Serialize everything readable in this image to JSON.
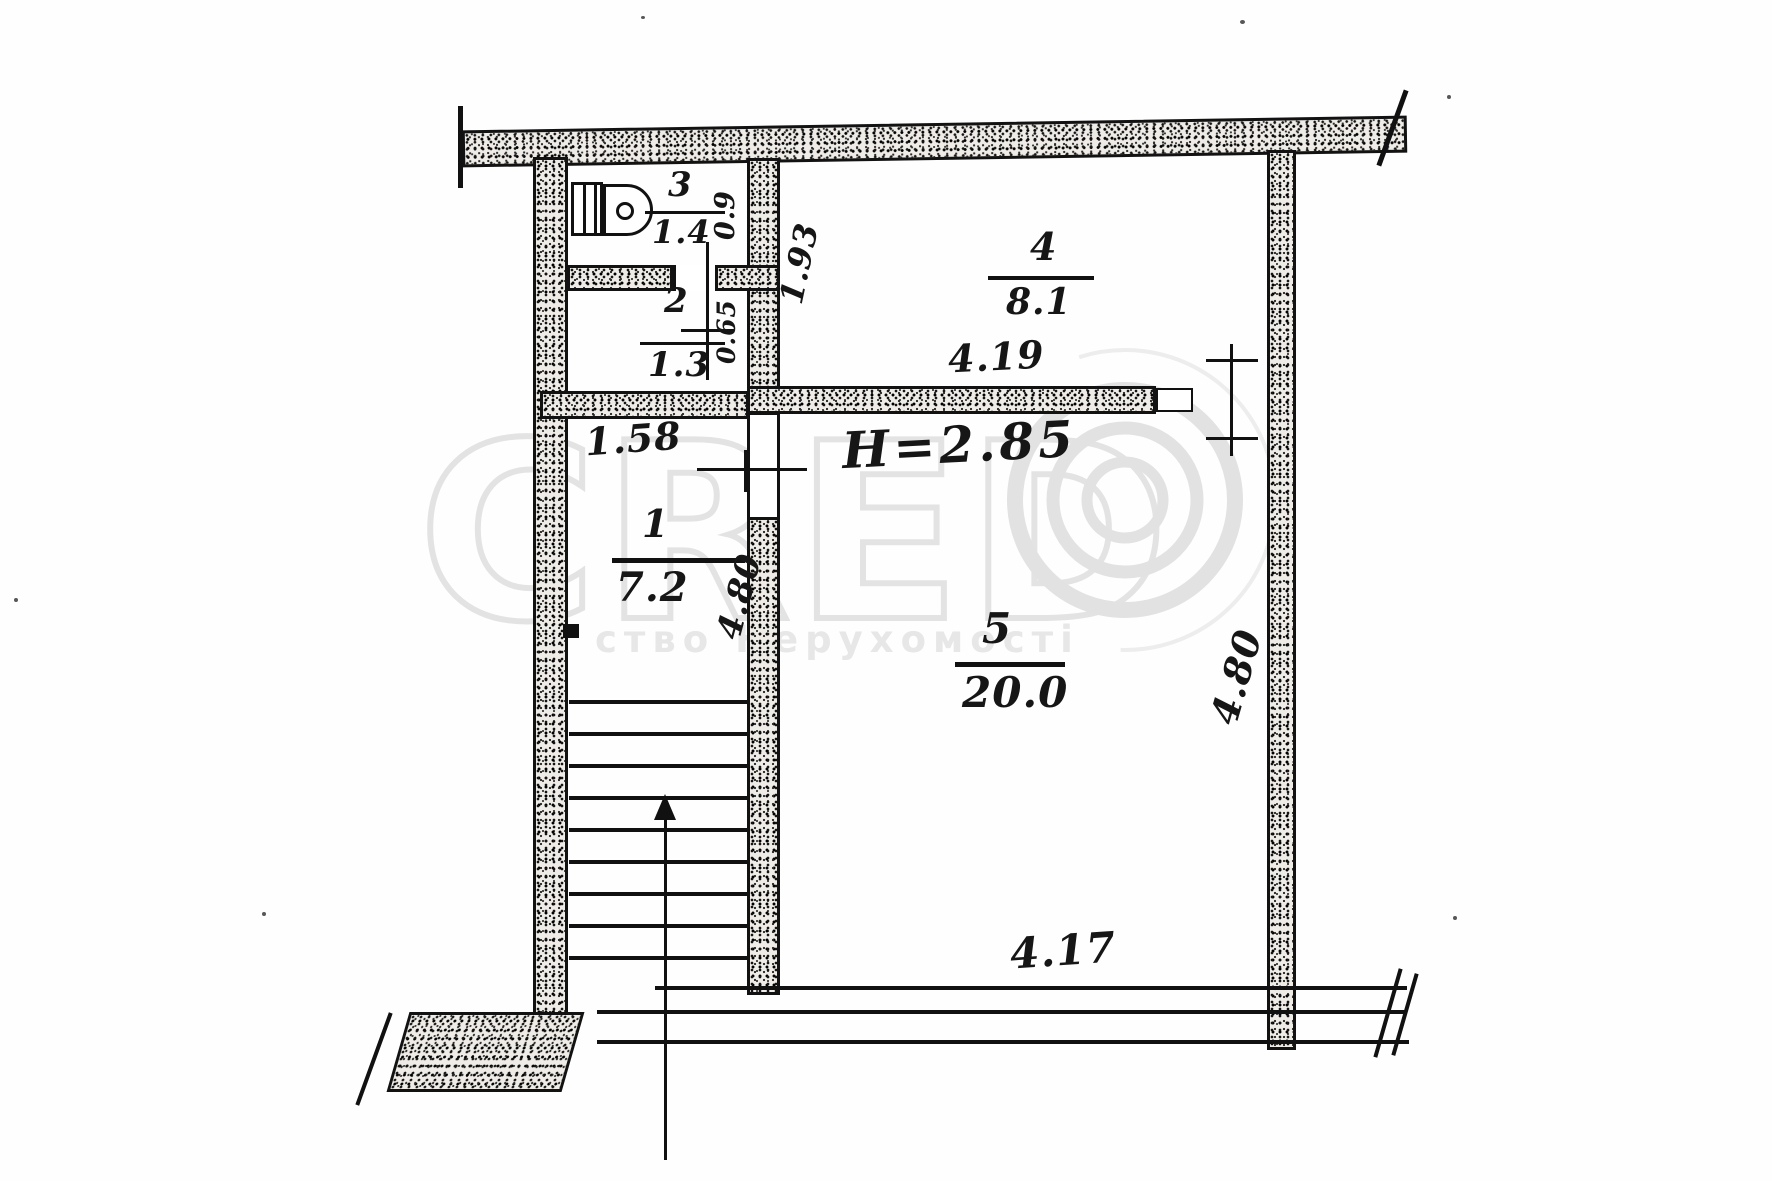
{
  "plan": {
    "rooms": [
      {
        "number": "1",
        "area": "7.2"
      },
      {
        "number": "2",
        "area": "1.3"
      },
      {
        "number": "3",
        "area": "1.4"
      },
      {
        "number": "4",
        "area": "8.1"
      },
      {
        "number": "5",
        "area": "20.0"
      }
    ],
    "dims": {
      "d09": "0.9",
      "d065": "0.65",
      "d193": "1.93",
      "d158": "1.58",
      "d419": "4.19",
      "d480_hall": "4.80",
      "d480_right": "4.80",
      "d417": "4.17",
      "height": "H=2.85"
    }
  },
  "watermark": {
    "letters": "CRED",
    "subtitle": "ство Нерухомості"
  }
}
